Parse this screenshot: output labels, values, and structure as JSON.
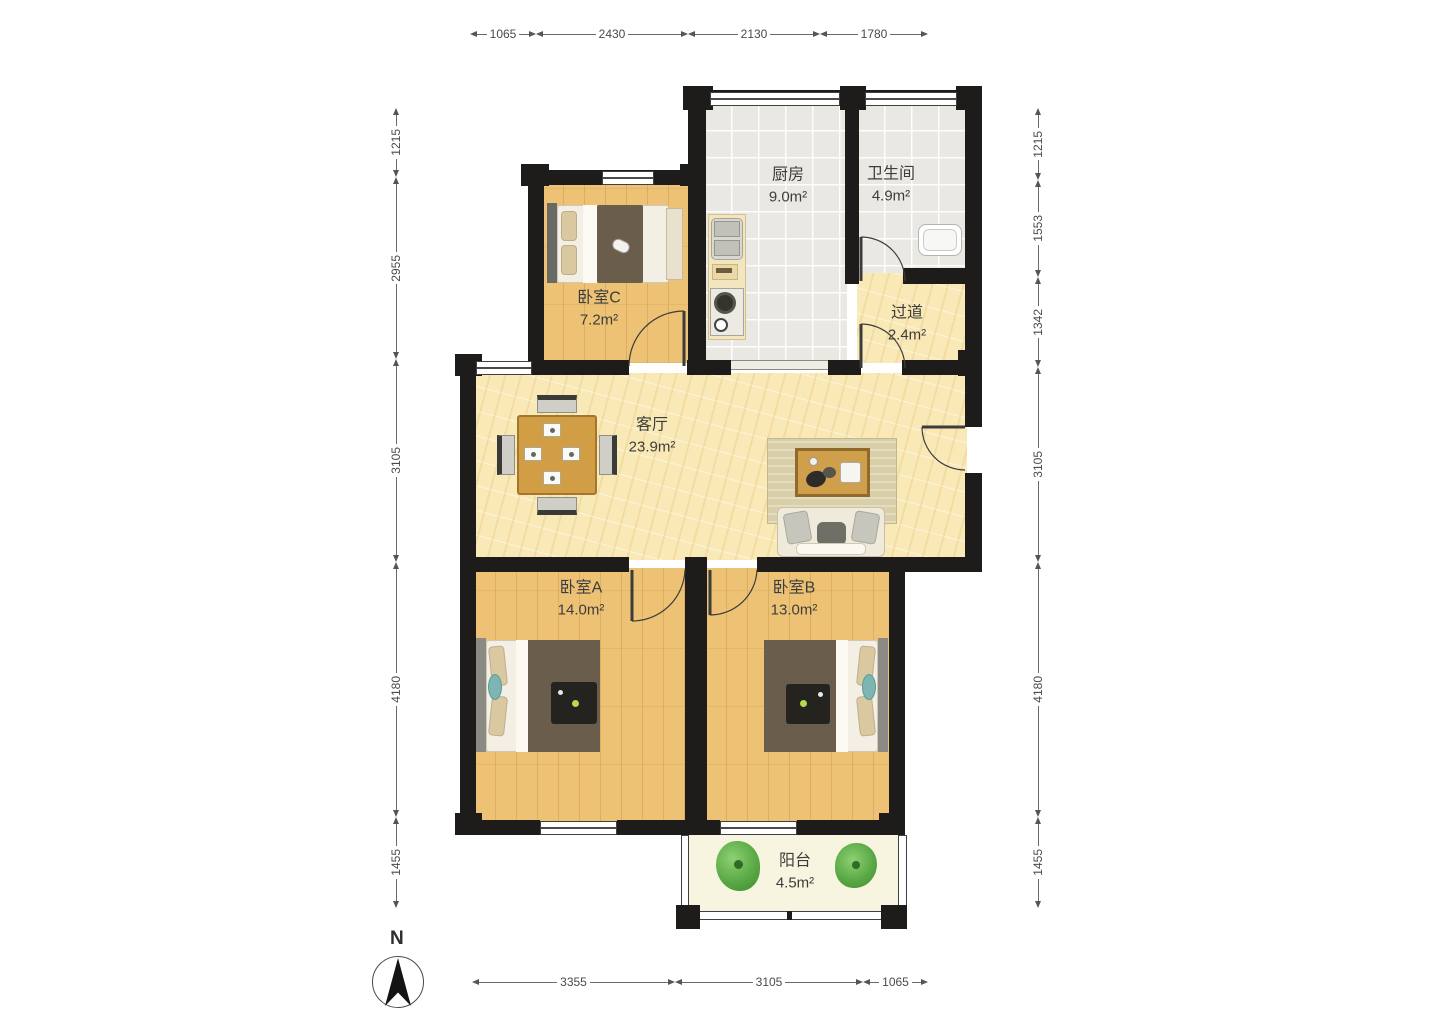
{
  "rooms": {
    "kitchen": {
      "name": "厨房",
      "area": "9.0m²"
    },
    "bathroom": {
      "name": "卫生间",
      "area": "4.9m²"
    },
    "bedroomC": {
      "name": "卧室C",
      "area": "7.2m²"
    },
    "hallway": {
      "name": "过道",
      "area": "2.4m²"
    },
    "living": {
      "name": "客厅",
      "area": "23.9m²"
    },
    "bedroomA": {
      "name": "卧室A",
      "area": "14.0m²"
    },
    "bedroomB": {
      "name": "卧室B",
      "area": "13.0m²"
    },
    "balcony": {
      "name": "阳台",
      "area": "4.5m²"
    }
  },
  "dimensions": {
    "top": [
      "1065",
      "2430",
      "2130",
      "1780"
    ],
    "bottom": [
      "3355",
      "3105",
      "1065"
    ],
    "left": [
      "1215",
      "2955",
      "3105",
      "4180",
      "1455"
    ],
    "right": [
      "1215",
      "1553",
      "1342",
      "3105",
      "4180",
      "1455"
    ]
  },
  "compass": {
    "label": "N"
  },
  "colors": {
    "wall": "#1d1c1a",
    "woodFloor": "#edc275",
    "stoneFloor": "#f8e9b7",
    "tileFloor": "#eae8e3",
    "balconyFloor": "#f7f5df",
    "blanket": "#6b5d4b",
    "mattress": "#f3efe5",
    "pillow": "#d9c8a0",
    "teal": "#7db5b2",
    "tableWood": "#d29e45",
    "chairGray": "#cfcfc7",
    "rug": "#d9cfa8",
    "sofaBase": "#f0eadb",
    "counter": "#f2e6c0",
    "plantGreen": "#5aa946",
    "doorLine": "#3c3c3c",
    "dimText": "#4a4a4a",
    "labelText": "#3d3d3d"
  }
}
